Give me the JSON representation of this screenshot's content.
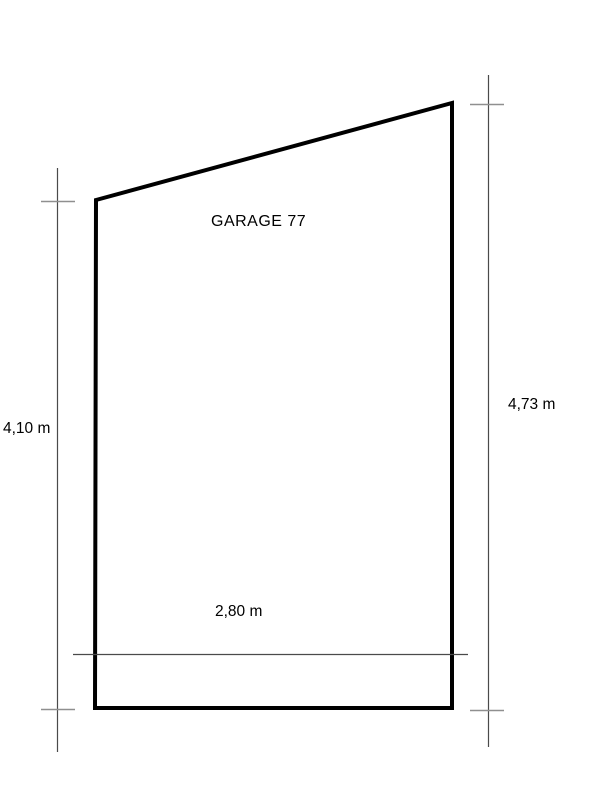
{
  "drawing": {
    "type": "floor-plan",
    "room_label": "GARAGE 77",
    "shape": "quadrilateral with slanted top edge rising left-to-right",
    "dimensions": {
      "left": {
        "label": "4,10 m",
        "value_m": 4.1,
        "side": "left-wall-height"
      },
      "right": {
        "label": "4,73 m",
        "value_m": 4.73,
        "side": "right-wall-height"
      },
      "width": {
        "label": "2,80 m",
        "value_m": 2.8,
        "side": "bottom-width"
      }
    },
    "colors": {
      "background": "#ffffff",
      "outline": "#000000",
      "dimension_line": "#4a4a4a",
      "tick": "#8f8f8f",
      "text": "#000000"
    }
  }
}
